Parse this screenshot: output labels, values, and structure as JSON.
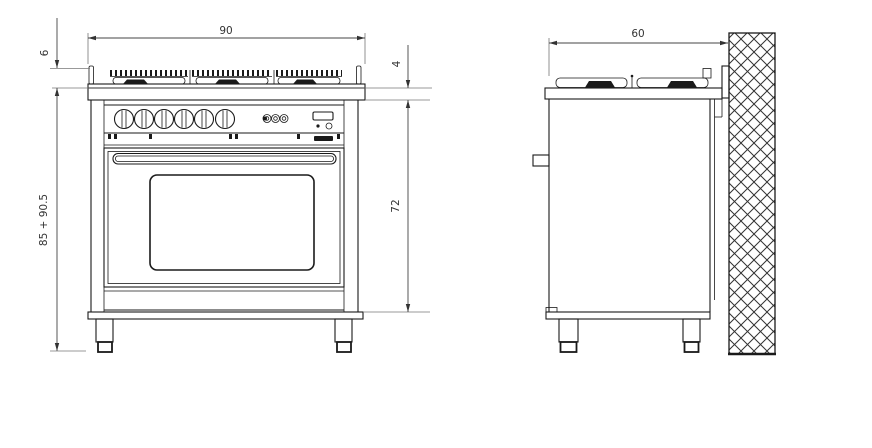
{
  "front_view": {
    "dims": {
      "width": "90",
      "hob_height": "6",
      "worktop_thickness": "4",
      "body_height": "72",
      "overall_height": "85 + 90.5"
    }
  },
  "side_view": {
    "dims": {
      "depth": "60"
    }
  },
  "colors": {
    "object_line": "#1a1a1a",
    "dimension_line": "#444444",
    "extension_line": "#777777",
    "background": "#ffffff",
    "wall_hatch_line": "#333333"
  },
  "icons": {
    "wall_hatch": "masonry-crosshatch-pattern"
  }
}
